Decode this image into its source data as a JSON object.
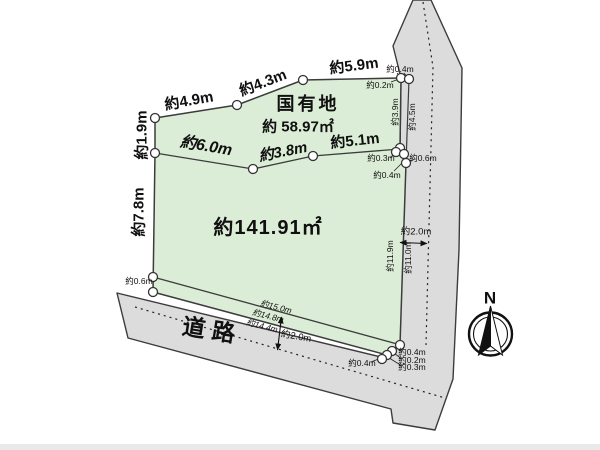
{
  "plot": {
    "main_area": "約141.91㎡",
    "national_name": "国有地",
    "national_area": "約 58.97㎡",
    "road": "道路",
    "north": "N"
  },
  "dim": {
    "top": [
      "約4.9m",
      "約4.3m",
      "約5.9m"
    ],
    "left": [
      "約1.9m",
      "約7.8m"
    ],
    "mid": [
      "約6.0m",
      "約3.8m",
      "約5.1m"
    ],
    "right_upper": [
      "約3.9m",
      "約4.5m"
    ],
    "right_lower": [
      "約11.9m",
      "約11.0m"
    ],
    "right_road_width": "約2.0m",
    "bottom_road_width": "約2.0m",
    "top_offsets": [
      "約0.4m",
      "約0.2m"
    ],
    "mid_offsets": [
      "約0.3m",
      "約0.4m",
      "約0.6m"
    ],
    "left_offset": "約0.6m",
    "bottom_lengths": [
      "約15.0m",
      "約14.8m",
      "約14.4m"
    ],
    "se_offsets": [
      "約0.4m",
      "約0.2m",
      "約0.3m"
    ],
    "se_offset_left": "約0.4m"
  },
  "colors": {
    "parcel_fill": "#dcedd7",
    "road_fill": "#dcdcdc",
    "line": "#333333",
    "point_fill": "#ffffff"
  }
}
